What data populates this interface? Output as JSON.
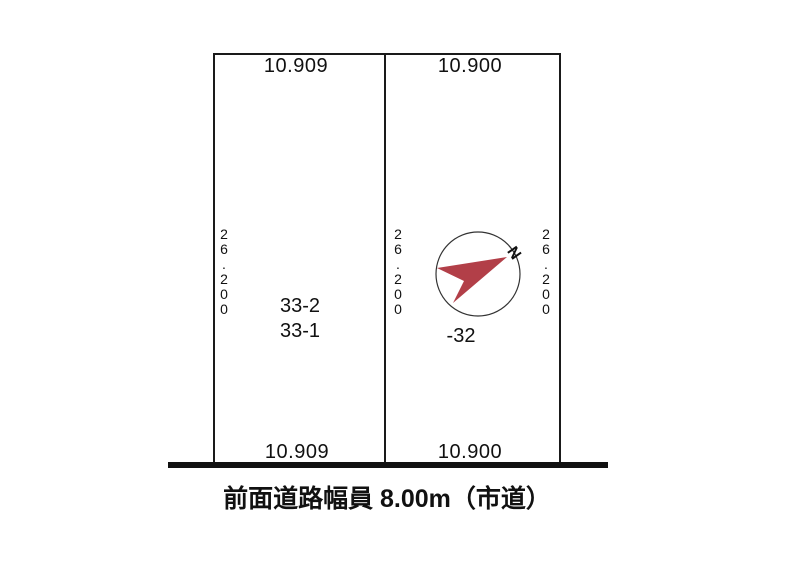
{
  "site_plan": {
    "left_plot": {
      "parcel_labels": [
        "33-2",
        "33-1"
      ],
      "top_width": "10.909",
      "bottom_width": "10.909",
      "depth": "26.200"
    },
    "right_plot": {
      "parcel_label": "-32",
      "top_width": "10.900",
      "bottom_width": "10.900",
      "depth_left": "26.200",
      "depth_right": "26.200"
    },
    "compass": {
      "north_label": "N",
      "arrow_color": "#b23f48",
      "circle_color": "#333333"
    },
    "road": {
      "caption": "前面道路幅員 8.00m（市道）"
    },
    "colors": {
      "line": "#1a1a1a",
      "background": "#ffffff"
    }
  }
}
